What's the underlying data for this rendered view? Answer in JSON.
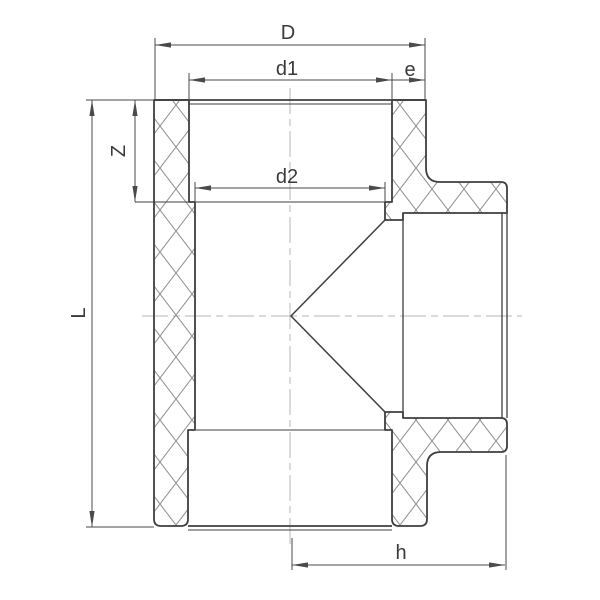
{
  "drawing": {
    "subject": "tee-fitting-cross-section",
    "dimensions": {
      "overall_width_label": "D",
      "top_socket_inner_diameter_label": "d1",
      "wall_thickness_label": "e",
      "insertion_depth_label": "Z",
      "bore_diameter_label": "d2",
      "overall_height_label": "L",
      "branch_center_to_face_label": "h"
    }
  },
  "colors": {
    "background": "#ffffff",
    "outline": "#3f3f3f",
    "dimension": "#4a4a4a",
    "hatch": "#909090",
    "centerline": "#b7b7b7",
    "label": "#3a3a3a",
    "arrow": "#4a4a4a"
  }
}
